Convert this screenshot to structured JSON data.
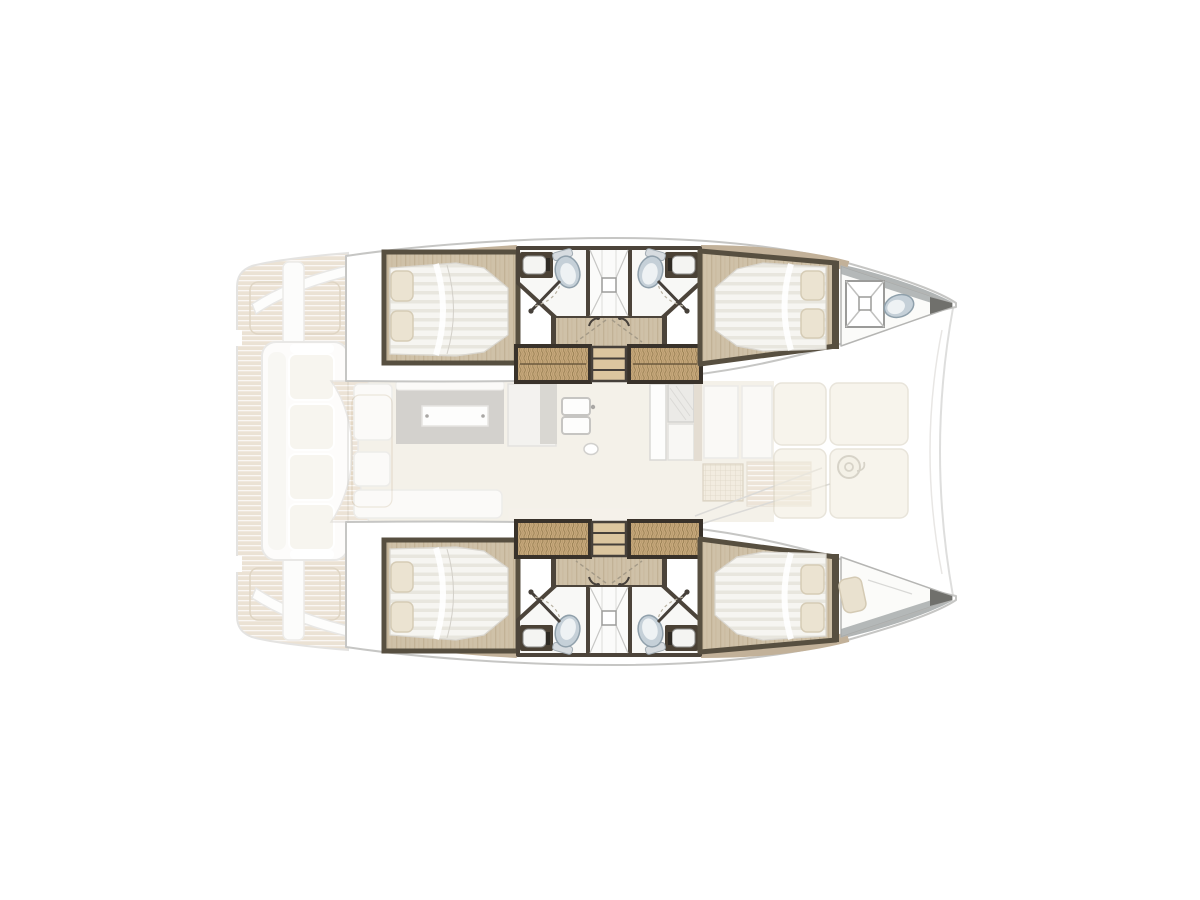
{
  "page": {
    "title": "Catamaran interior layout floor plan",
    "background": "#ffffff",
    "canvas": {
      "width": 1200,
      "height": 900
    }
  },
  "diagram": {
    "type": "boat-floor-plan",
    "vessel_type": "sailing catamaran",
    "view": "overhead deck plan",
    "orientation": "bow-right",
    "render_style": "hull cabins solid, exterior decks and salon ghosted",
    "areas": {
      "aft_deck": {
        "label": "Aft cockpit deck (ghosted)",
        "features": [
          "teak plank decking",
          "aft bench seat with cushions",
          "curved transom bars",
          "helm seat pads",
          "stern steps"
        ]
      },
      "salon": {
        "label": "Main-deck salon and galley (ghosted)",
        "features": [
          "dining table with white tabletop",
          "sofa seating",
          "galley island",
          "double sink",
          "refrigerator",
          "stove unit",
          "galley counters",
          "teak side deck strip"
        ]
      },
      "foredeck": {
        "label": "Foredeck lounge (ghosted)",
        "features": [
          "cream sun-pad panels",
          "windlass winch",
          "forward crossbeam arc"
        ]
      },
      "port_hull": {
        "label": "Port hull (top)",
        "rooms": [
          "aft double cabin with island bed and two pillows",
          "aft bathroom with vanity sink and toilet",
          "central shared shower with drain",
          "forward bathroom with vanity sink and toilet",
          "companionway stairs with wicker treads",
          "forward double cabin with island bed and two pillows",
          "forepeak with hatch grate and toilet"
        ]
      },
      "starboard_hull": {
        "label": "Starboard hull (bottom)",
        "rooms": [
          "aft double cabin with island bed and two pillows",
          "aft bathroom with vanity sink and toilet",
          "central shared shower with drain",
          "forward bathroom with vanity sink and toilet",
          "companionway stairs with wicker treads",
          "forward double cabin with island bed and two pillows",
          "forepeak single berth"
        ]
      }
    },
    "fixture_counts": {
      "double_cabins": 4,
      "bathrooms": 4,
      "showers": 2,
      "toilets": 5,
      "sinks": 4,
      "stairways": 2,
      "forepeak_berths": 1
    },
    "colors": {
      "background": "#ffffff",
      "hull_outline": "#c6c6c4",
      "wood_floor": "#cfc1a8",
      "dark_wall": "#574f40",
      "wicker_stair": "#c9ab7d",
      "bed_linen": "#f6f5f1",
      "pillow": "#ebe3d1",
      "toilet_blue": "#c5d0d8",
      "bathroom_floor": "#f8f8f6",
      "teak_deck": "#dccbb2",
      "cream_panel": "#f3eee1",
      "ghost_gray": "#aca89e",
      "bow_gray": "#a3a8a8"
    }
  }
}
